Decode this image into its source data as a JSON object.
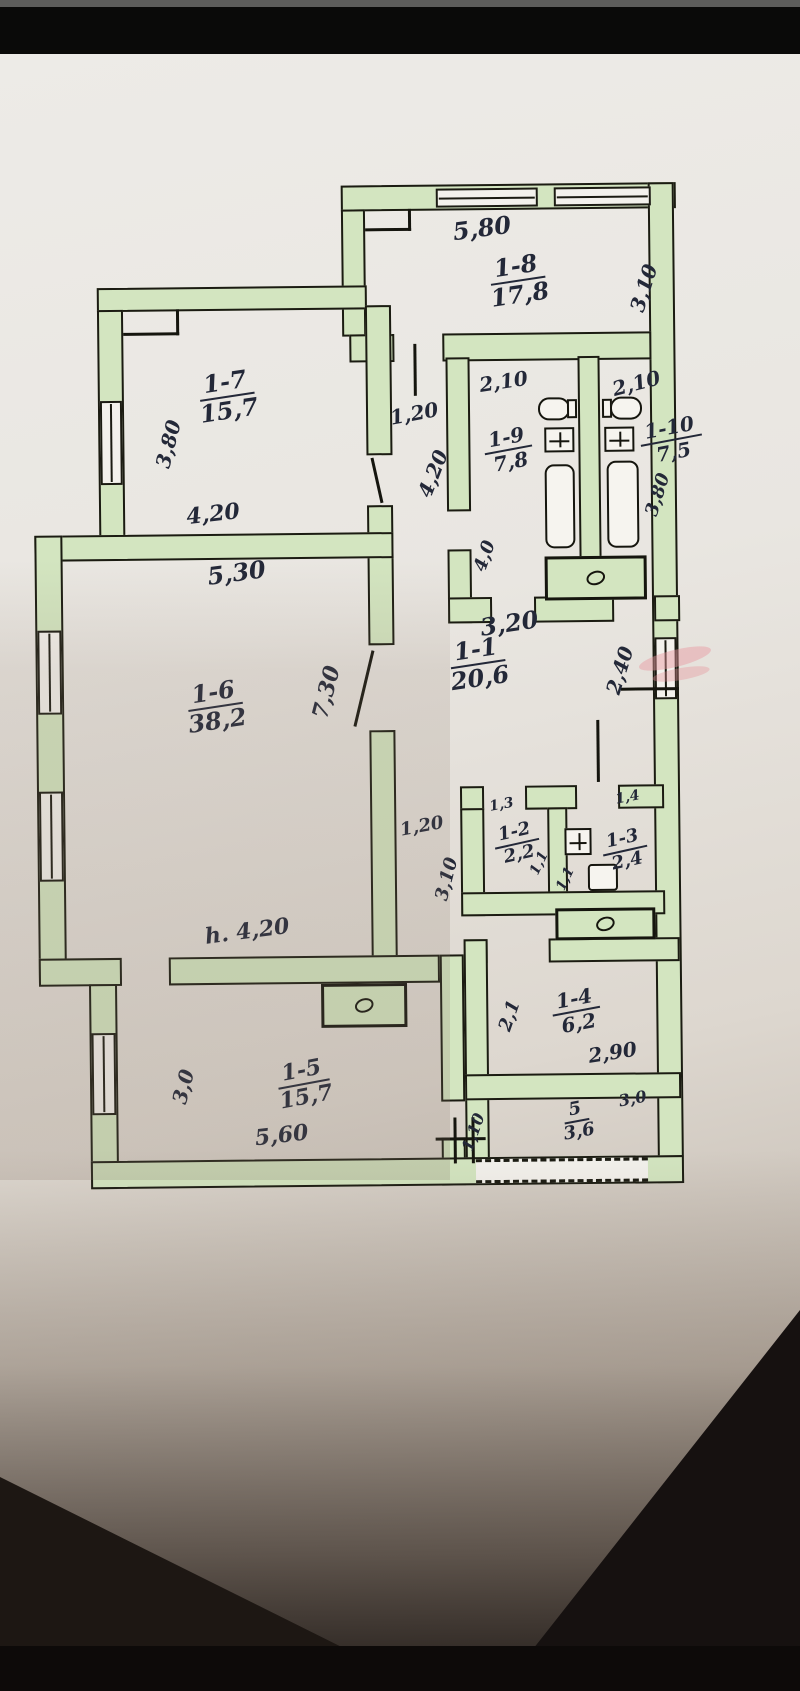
{
  "colors": {
    "ink": "#232838",
    "wall_fill": "#d3e5c0",
    "wall_line": "#1b1b12",
    "paper": "#e9e6e1",
    "photo_background": "#0c0b0a"
  },
  "rooms": {
    "r11": {
      "num": "1-1",
      "area": "20,6"
    },
    "r12": {
      "num": "1-2",
      "area": "2,2"
    },
    "r13": {
      "num": "1-3",
      "area": "2,4"
    },
    "r14": {
      "num": "1-4",
      "area": "6,2"
    },
    "r15": {
      "num": "1-5",
      "area": "15,7"
    },
    "r16": {
      "num": "1-6",
      "area": "38,2"
    },
    "r17": {
      "num": "1-7",
      "area": "15,7"
    },
    "r18": {
      "num": "1-8",
      "area": "17,8"
    },
    "r19": {
      "num": "1-9",
      "area": "7,8"
    },
    "r110": {
      "num": "1-10",
      "area": "7,5"
    },
    "r5": {
      "num": "5",
      "area": "3,6"
    }
  },
  "dims": {
    "d580": "5,80",
    "d310_18": "3,10",
    "d380_17": "3,80",
    "d420_17": "4,20",
    "d120_corr": "1,20",
    "d420_corr": "4,20",
    "d210_19": "2,10",
    "d210_110": "2,10",
    "d380_110": "3,80",
    "d40_corr": "4,0",
    "d320_corr": "3,20",
    "d240_corr": "2,40",
    "d530_16": "5,30",
    "d730_16": "7,30",
    "h420_16": "h. 4,20",
    "d120_leg": "1,20",
    "d310_leg": "3,10",
    "d13_12": "1,3",
    "d14_13": "1,4",
    "d11_a": "1,1",
    "d11_b": "1,1",
    "d21_14": "2,1",
    "d290_14": "2,90",
    "d30_5": "3,0",
    "d110_5": "1,10",
    "d30_15": "3,0",
    "d560_15": "5,60"
  }
}
